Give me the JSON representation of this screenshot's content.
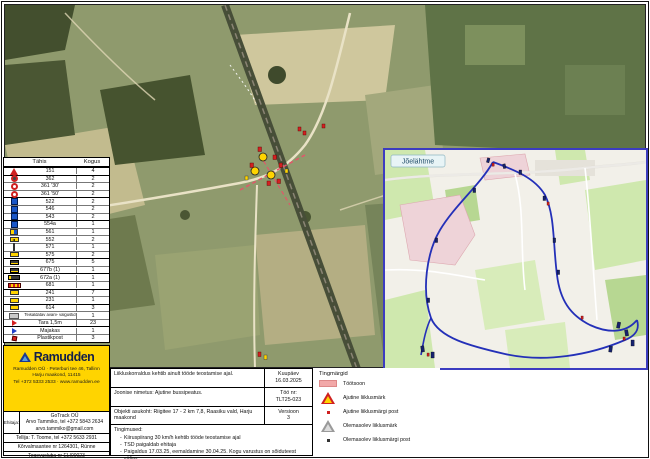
{
  "sign_table": {
    "header_code": "Tähis",
    "header_qty": "Kogus",
    "rows": [
      {
        "icon": "ic-tri",
        "code": "151",
        "qty": "4",
        "group": true
      },
      {
        "icon": "ic-circ dark",
        "code": "362",
        "qty": "2",
        "group": true
      },
      {
        "icon": "ic-circ",
        "code": "361 '30'",
        "qty": "2",
        "group": false
      },
      {
        "icon": "ic-circ",
        "code": "361 '50'",
        "qty": "2",
        "group": false
      },
      {
        "icon": "ic-bluesq",
        "code": "522",
        "qty": "2",
        "group": true
      },
      {
        "icon": "ic-bluesq",
        "code": "546",
        "qty": "2",
        "group": false
      },
      {
        "icon": "ic-bluesq",
        "code": "543",
        "qty": "2",
        "group": false
      },
      {
        "icon": "ic-bluesq",
        "code": "554a",
        "qty": "1",
        "group": true
      },
      {
        "icon": "ic-ylblue",
        "code": "561",
        "qty": "1",
        "group": false
      },
      {
        "icon": "ic-ylarrow",
        "code": "552",
        "qty": "2",
        "group": false
      },
      {
        "icon": "ic-post",
        "code": "571",
        "qty": "1",
        "group": false
      },
      {
        "icon": "ic-ylplate",
        "code": "575",
        "qty": "2",
        "group": false
      },
      {
        "icon": "ic-dkplate",
        "code": "675",
        "qty": "5",
        "group": true
      },
      {
        "icon": "ic-dkplate",
        "code": "677b (1)",
        "qty": "1",
        "group": false
      },
      {
        "icon": "ic-dkwide",
        "code": "672a (1)",
        "qty": "1",
        "group": true
      },
      {
        "icon": "ic-striped",
        "code": "681",
        "qty": "1",
        "group": false
      },
      {
        "icon": "ic-ylplate",
        "code": "241",
        "qty": "7",
        "group": true
      },
      {
        "icon": "ic-ylplate",
        "code": "231",
        "qty": "1",
        "group": false
      },
      {
        "icon": "ic-ylplate",
        "code": "614",
        "qty": "3",
        "group": true
      },
      {
        "icon": "ic-greyplate",
        "code": "Teisaldatav avarii- valgustid",
        "qty": "1",
        "group": false,
        "small": true
      },
      {
        "icon": "ic-flagred",
        "code": "Tara 1,5m",
        "qty": "23",
        "group": false
      },
      {
        "icon": "ic-flagblue",
        "code": "Majakas",
        "qty": "1",
        "group": true
      },
      {
        "icon": "ic-markred",
        "code": "Plastikpost",
        "qty": "3",
        "group": false
      }
    ]
  },
  "inset": {
    "place_label": "Jõelähtme"
  },
  "footer": {
    "ramudden": {
      "brand": "Ramudden",
      "address_lines": [
        "Ramudden OÜ · Peterburi tee 46, Tallinn",
        "Harju maakond, 11415",
        "Tel +372 5333 2533 · www.ramudden.ee"
      ]
    },
    "contact": {
      "builder_label": "Ehitaja:",
      "builder_lines": [
        "GoTrack OÜ",
        "Arvo Tammiko, tel +372 5843 2634",
        "arvo.tammiko@gmail.com"
      ],
      "client": "Tellija: T. Toome, tel +372 5633 2931",
      "object": "Kõrvalmaantee nr 1264301, Rünne",
      "license": "Tegevusluba nr ELI00023"
    },
    "info": {
      "notice": "Liikluskorraldus kehtib ainult tööde teostamise ajal.",
      "date_label": "Kuupäev",
      "date": "16.03.2025",
      "drawing": "Joonise nimetus: Ajutine bussipeatus.",
      "job_label": "Töö nr:",
      "job": "TLT25-023",
      "location": "Objekti asukoht: Riigitee 17 - 2 km 7,8, Raasiku vald, Harju maakond",
      "version_label": "Versioon",
      "version": "3",
      "conditions_label": "Tingimused:",
      "conditions": [
        "Kiiruspiirang 30 km/h kehtib tööde teostamise ajal",
        "TSD paigaldab ehitaja",
        "Paigaldus 17.03.25, eemaldamine 30.04.25. Kogu varustus on sõiduteest väljas"
      ]
    },
    "legend": {
      "title": "Tingmärgid",
      "items": [
        {
          "icon": "li-zone",
          "label": "Töötsoon"
        },
        {
          "icon": "li-tri-red",
          "label": "Ajutine liiklusmärk"
        },
        {
          "icon": "li-dot-red",
          "label": "Ajutine liiklusmärgi post"
        },
        {
          "icon": "li-tri-grey",
          "label": "Olemasolev liiklusmärk"
        },
        {
          "icon": "li-dot-dark",
          "label": "Olemasolev liiklusmärgi post"
        }
      ]
    }
  },
  "colors": {
    "brand_yellow": "#ffd400",
    "brand_navy": "#14204a",
    "workzone_pink": "#f2a8a8",
    "route_blue": "#2430b8",
    "inset_border": "#3c3cc0"
  }
}
